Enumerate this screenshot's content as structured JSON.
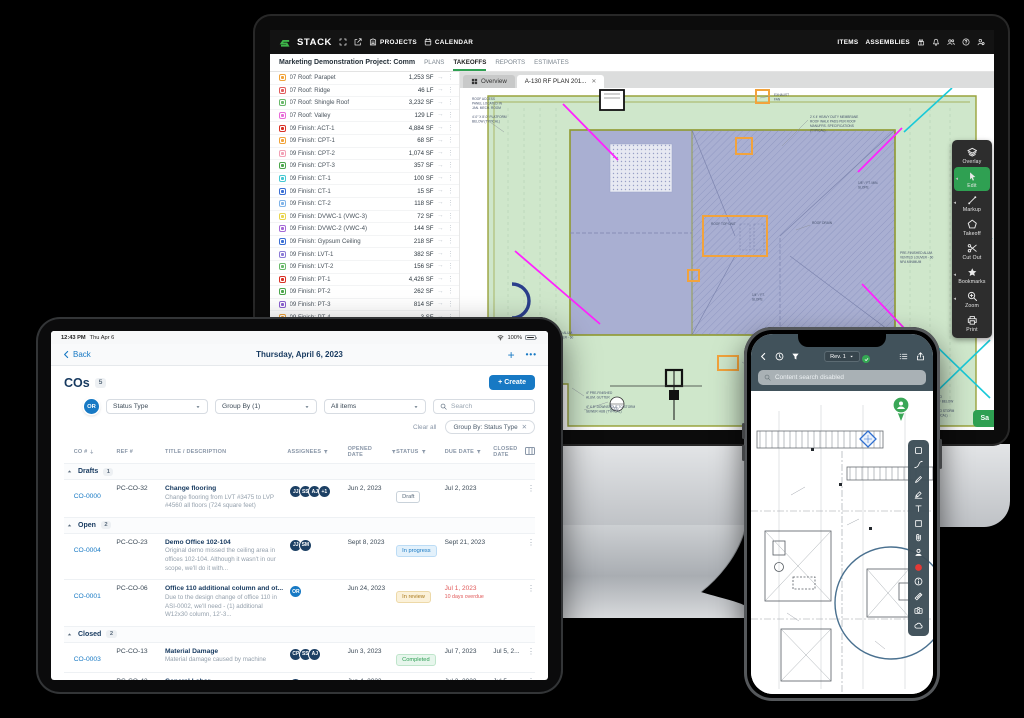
{
  "colors": {
    "accent_green": "#2fa052",
    "logo_green": "#3eb549",
    "link_blue": "#1779c4",
    "navy": "#16395f",
    "overdue_red": "#e05959",
    "avatar_navy": "#1d4064",
    "dot_grey": "#b3bcc4",
    "dot_orange": "#f5a623",
    "dot_green": "#35b558"
  },
  "desktop": {
    "topbar": {
      "logo": "STACK",
      "projects": "PROJECTS",
      "calendar": "CALENDAR",
      "items": "ITEMS",
      "assemblies": "ASSEMBLIES"
    },
    "projectbar": {
      "title": "Marketing Demonstration Project: Comm",
      "tabs": [
        "PLANS",
        "TAKEOFFS",
        "REPORTS",
        "ESTIMATES"
      ],
      "active_tab": "TAKEOFFS"
    },
    "takeoffs": [
      {
        "name": "07 Roof: Parapet",
        "qty": "1,253 SF",
        "color": "#f0a33a"
      },
      {
        "name": "07 Roof: Ridge",
        "qty": "46 LF",
        "color": "#e05c5c"
      },
      {
        "name": "07 Roof: Shingle Roof",
        "qty": "3,232 SF",
        "color": "#69b86a"
      },
      {
        "name": "07 Roof: Valley",
        "qty": "129 LF",
        "color": "#e86bd8"
      },
      {
        "name": "09 Finish: ACT-1",
        "qty": "4,884 SF",
        "color": "#d93025"
      },
      {
        "name": "09 Finish: CPT-1",
        "qty": "68 SF",
        "color": "#f0a33a"
      },
      {
        "name": "09 Finish: CPT-2",
        "qty": "1,074 SF",
        "color": "#f2a0b5"
      },
      {
        "name": "09 Finish: CPT-3",
        "qty": "357 SF",
        "color": "#4ca64c"
      },
      {
        "name": "09 Finish: CT-1",
        "qty": "100 SF",
        "color": "#46c8d2"
      },
      {
        "name": "09 Finish: CT-1",
        "qty": "15 SF",
        "color": "#3b6fd4"
      },
      {
        "name": "09 Finish: CT-2",
        "qty": "118 SF",
        "color": "#7fb3e8"
      },
      {
        "name": "09 Finish: DVWC-1 (VWC-3)",
        "qty": "72 SF",
        "color": "#e8d44d"
      },
      {
        "name": "09 Finish: DVWC-2 (VWC-4)",
        "qty": "144 SF",
        "color": "#a569d6"
      },
      {
        "name": "09 Finish: Gypsum Ceiling",
        "qty": "218 SF",
        "color": "#3b6fd4"
      },
      {
        "name": "09 Finish: LVT-1",
        "qty": "382 SF",
        "color": "#8b7ad6"
      },
      {
        "name": "09 Finish: LVT-2",
        "qty": "156 SF",
        "color": "#69b86a"
      },
      {
        "name": "09 Finish: PT-1",
        "qty": "4,426 SF",
        "color": "#d93025"
      },
      {
        "name": "09 Finish: PT-2",
        "qty": "262 SF",
        "color": "#4ca64c"
      },
      {
        "name": "09 Finish: PT-3",
        "qty": "814 SF",
        "color": "#8a5fd0"
      },
      {
        "name": "09 Finish: PT-4",
        "qty": "3 SF",
        "color": "#f0a33a"
      }
    ],
    "plan_tabs": {
      "overview": "Overview",
      "active": "A-130 RF PLAN 201...",
      "close": "✕"
    },
    "tools": [
      {
        "label": "Overlay",
        "icon": "layers",
        "active": false,
        "flyout": false
      },
      {
        "label": "Edit",
        "icon": "cursor",
        "active": true,
        "flyout": true
      },
      {
        "label": "Markup",
        "icon": "markup",
        "active": false,
        "flyout": true
      },
      {
        "label": "Takeoff",
        "icon": "pentagon",
        "active": false,
        "flyout": false
      },
      {
        "label": "Cut Out",
        "icon": "scissors",
        "active": false,
        "flyout": false
      },
      {
        "label": "Bookmarks",
        "icon": "star",
        "active": false,
        "flyout": true
      },
      {
        "label": "Zoom",
        "icon": "zoom",
        "active": false,
        "flyout": true
      },
      {
        "label": "Print",
        "icon": "printer",
        "active": false,
        "flyout": false
      }
    ],
    "save_label": "Sa",
    "plan_annotations": [
      {
        "x": 12,
        "y": 12,
        "t": "ROOF ACCESS"
      },
      {
        "x": 12,
        "y": 16.5,
        "t": "PANEL LOCATED IN"
      },
      {
        "x": 12,
        "y": 21,
        "t": "JAN. MECH. ROOM"
      },
      {
        "x": 12,
        "y": 30,
        "t": "4′-0″ X 8′-0″ PLATFORM"
      },
      {
        "x": 12,
        "y": 34.5,
        "t": "BELOW (TYPICAL)"
      },
      {
        "x": 314,
        "y": 8,
        "t": "EXHAUST"
      },
      {
        "x": 314,
        "y": 12.5,
        "t": "FAN"
      },
      {
        "x": 350,
        "y": 30,
        "t": "2 X 4′ HEAVY DUTY MEMBRANE"
      },
      {
        "x": 350,
        "y": 34.5,
        "t": "ROOF WALK PADS PER ROOF"
      },
      {
        "x": 350,
        "y": 39,
        "t": "MANUFRS. SPECIFICATIONS"
      },
      {
        "x": 350,
        "y": 43.5,
        "t": "(TYPICAL)"
      },
      {
        "x": 251,
        "y": 137,
        "t": "ROOF TOP UNIT"
      },
      {
        "x": 398,
        "y": 96,
        "t": "1/8″ / FT. MIN."
      },
      {
        "x": 398,
        "y": 100.5,
        "t": "SLOPE"
      },
      {
        "x": 352,
        "y": 136,
        "t": "ROOF DRAIN"
      },
      {
        "x": 292,
        "y": 208,
        "t": "1/4″ / FT."
      },
      {
        "x": 292,
        "y": 212.5,
        "t": "SLOPE"
      },
      {
        "x": 440,
        "y": 166,
        "t": "PRE-FINISHED ALUM."
      },
      {
        "x": 440,
        "y": 170.5,
        "t": "VENTED LOUVER - 60"
      },
      {
        "x": 440,
        "y": 175,
        "t": "NFA MINIMUM"
      },
      {
        "x": 80,
        "y": 246,
        "t": "PRE-FINISHED ALUM."
      },
      {
        "x": 80,
        "y": 250.5,
        "t": "VENTED LOUVER - 60"
      },
      {
        "x": 80,
        "y": 255,
        "t": "NFA MINIMUM"
      },
      {
        "x": 300,
        "y": 284,
        "t": "CONDENSING"
      },
      {
        "x": 300,
        "y": 288.5,
        "t": "UNIT"
      },
      {
        "x": 126,
        "y": 306,
        "t": "4″ PRE-FINISHED"
      },
      {
        "x": 126,
        "y": 310.5,
        "t": "ALUM. GUTTER"
      },
      {
        "x": 126,
        "y": 320,
        "t": "4″ X 8″ DOWNSPOUT TO STORM"
      },
      {
        "x": 126,
        "y": 324.5,
        "t": "SEWER HUB (TYPICAL)"
      },
      {
        "x": 2,
        "y": 304,
        "t": "DOWNSPOUT TO STORM"
      },
      {
        "x": 2,
        "y": 308.5,
        "t": "(TYPICAL)"
      },
      {
        "x": 452,
        "y": 310,
        "t": "4″ DOWNSPOUT TO"
      },
      {
        "x": 452,
        "y": 314.5,
        "t": "GUTTER ON ROOF BELOW"
      },
      {
        "x": 452,
        "y": 324,
        "t": "4″ DOWNSPOUT TO STORM"
      },
      {
        "x": 452,
        "y": 328.5,
        "t": "SEWER HUB (TYPICAL)"
      },
      {
        "x": 150,
        "y": 318,
        "t": "1"
      },
      {
        "x": 150,
        "y": 322,
        "t": "A-330"
      }
    ]
  },
  "tablet": {
    "statusbar": {
      "time": "12:43 PM",
      "date": "Thu Apr 6",
      "battery": "100%"
    },
    "navbar": {
      "back": "Back",
      "title": "Thursday, April 6, 2023",
      "plus": "+",
      "more": "•••"
    },
    "header": {
      "title": "COs",
      "count": "5",
      "create": "+ Create"
    },
    "filters": {
      "avatar": "OR",
      "dropdowns": [
        "Status Type",
        "Group By (1)",
        "All items"
      ],
      "search_placeholder": "Search",
      "clear": "Clear all",
      "chip": "Group By: Status Type",
      "chip_close": "✕"
    },
    "columns": [
      "CO #",
      "REF #",
      "TITLE / DESCRIPTION",
      "ASSIGNEES",
      "OPENED DATE",
      "STATUS",
      "DUE DATE",
      "CLOSED DATE"
    ],
    "groups": [
      {
        "label": "Drafts",
        "count": "1",
        "rows": [
          {
            "dot": "#b3bcc4",
            "co": "CO-0000",
            "ref": "PC-CO-32",
            "title": "Change flooring",
            "desc": "Change flooring from LVT #3475 to LVP #4560 all floors (724 square feet)",
            "assignees": [
              {
                "t": "JJ",
                "c": "navy"
              },
              {
                "t": "SS",
                "c": "navy"
              },
              {
                "t": "AJ",
                "c": "navy"
              },
              {
                "t": "+1",
                "c": "navy"
              }
            ],
            "opened": "Jun 2, 2023",
            "status": "Draft",
            "status_style": "st-draft",
            "due": "Jul 2, 2023",
            "due_note": "",
            "closed": ""
          }
        ]
      },
      {
        "label": "Open",
        "count": "2",
        "rows": [
          {
            "dot": "#f5a623",
            "co": "CO-0004",
            "ref": "PC-CO-23",
            "title": "Demo Office 102-104",
            "desc": "Original demo missed the ceiling area in offices 102-104. Although it wasn't in our scope, we'll do it with...",
            "assignees": [
              {
                "t": "JJ",
                "c": "navy"
              },
              {
                "t": "SM",
                "c": "navy"
              }
            ],
            "opened": "Sept 8, 2023",
            "status": "In progress",
            "status_style": "st-progress",
            "due": "Sept 21, 2023",
            "due_note": "",
            "closed": ""
          },
          {
            "dot": "#f5a623",
            "co": "CO-0001",
            "ref": "PC-CO-06",
            "title": "Office 110 additional column and ot...",
            "desc": "Due to the design change of office 110 in ASI-0002, we'll need - (1) additional W12x30 column, 12'-3...",
            "assignees": [
              {
                "t": "OR",
                "c": "blue"
              }
            ],
            "opened": "Jun 24, 2023",
            "status": "In review",
            "status_style": "st-review",
            "due": "Jul 1, 2023",
            "due_overdue": true,
            "due_note": "10 days overdue",
            "closed": ""
          }
        ]
      },
      {
        "label": "Closed",
        "count": "2",
        "rows": [
          {
            "dot": "#35b558",
            "co": "CO-0003",
            "ref": "PC-CO-13",
            "title": "Material Damage",
            "desc": "Material damage caused by machine",
            "assignees": [
              {
                "t": "CP",
                "c": "navy"
              },
              {
                "t": "SS",
                "c": "navy"
              },
              {
                "t": "AJ",
                "c": "navy"
              }
            ],
            "opened": "Jun 3, 2023",
            "status": "Completed",
            "status_style": "st-completed",
            "due": "Jul 7, 2023",
            "due_note": "",
            "closed": "Jul 5, 2..."
          },
          {
            "dot": "#35b558",
            "co": "CO-0002",
            "ref": "PC-CO-42",
            "title": "General Labor",
            "desc": "",
            "assignees": [
              {
                "t": "RH",
                "c": "navy"
              }
            ],
            "opened": "Jun 4, 2023",
            "status": "Voided",
            "status_style": "st-voided",
            "due": "Jul 2, 2023",
            "due_note": "",
            "closed": "Jul 5, 20..."
          }
        ]
      }
    ]
  },
  "phone": {
    "toolbar": {
      "rev": "Rev. 1"
    },
    "search_placeholder": "Content search disabled",
    "tools": [
      "sel-rect",
      "arc",
      "pen",
      "marker",
      "text-T",
      "square",
      "clip",
      "person",
      "dot-red",
      "info",
      "ruler",
      "camera",
      "cloud"
    ]
  }
}
